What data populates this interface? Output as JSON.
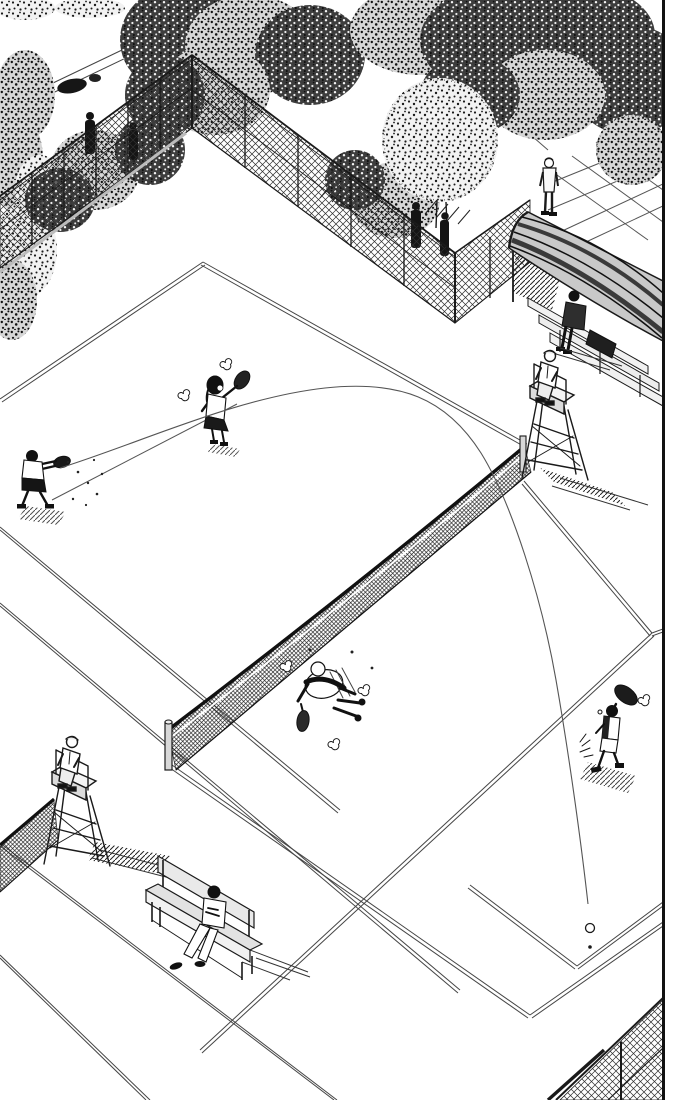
{
  "panel": {
    "type": "manga panel (textless illustration)",
    "scene": "Aerial isometric view of outdoor tennis courts during a doubles rally; a thin trajectory line shows a lob arcing from the far-left player over the net beside the umpire chair, landing as a small ball near the lower-right baseline",
    "ink_color": "#1a1a1a",
    "paper_color": "#ffffff",
    "border": {
      "side": "right",
      "color": "#111111",
      "width_px": 3
    }
  },
  "court": {
    "courts_visible": 2,
    "nets_visible": 2,
    "surface_color": "#ffffff",
    "line_color": "#444444",
    "line_style": "double parallel thin lines"
  },
  "figures": {
    "players": [
      {
        "id": "far-left-player",
        "action": "follow-through swing after hitting the lob",
        "position": "far court, left side"
      },
      {
        "id": "far-center-player",
        "action": "female player standing with racket raised",
        "position": "far court, center, long hair"
      },
      {
        "id": "near-diving-player",
        "action": "stumbling forward, racket dangling down",
        "position": "near court, center, dust puffs around"
      },
      {
        "id": "near-right-player",
        "action": "racket raised overhead chasing the lob",
        "position": "near court, right side"
      }
    ],
    "umpires_on_chairs": 2,
    "spectators_seated": 2,
    "spectators_standing": 1,
    "silhouettes_behind_fence": 4
  },
  "props": {
    "umpire_chairs": 2,
    "benches": 1,
    "canopy_grandstand": 1,
    "chain_link_fence_sections": 4,
    "trees": "dense stippled canopies along the top edge",
    "tennis_ball": {
      "x": 590,
      "y": 928
    }
  },
  "trajectory": {
    "from": "far-left player's racket",
    "over": "net beside the right umpire chair",
    "to": "small open-circle ball mark at lower right",
    "style": "thin single-pixel arc"
  }
}
